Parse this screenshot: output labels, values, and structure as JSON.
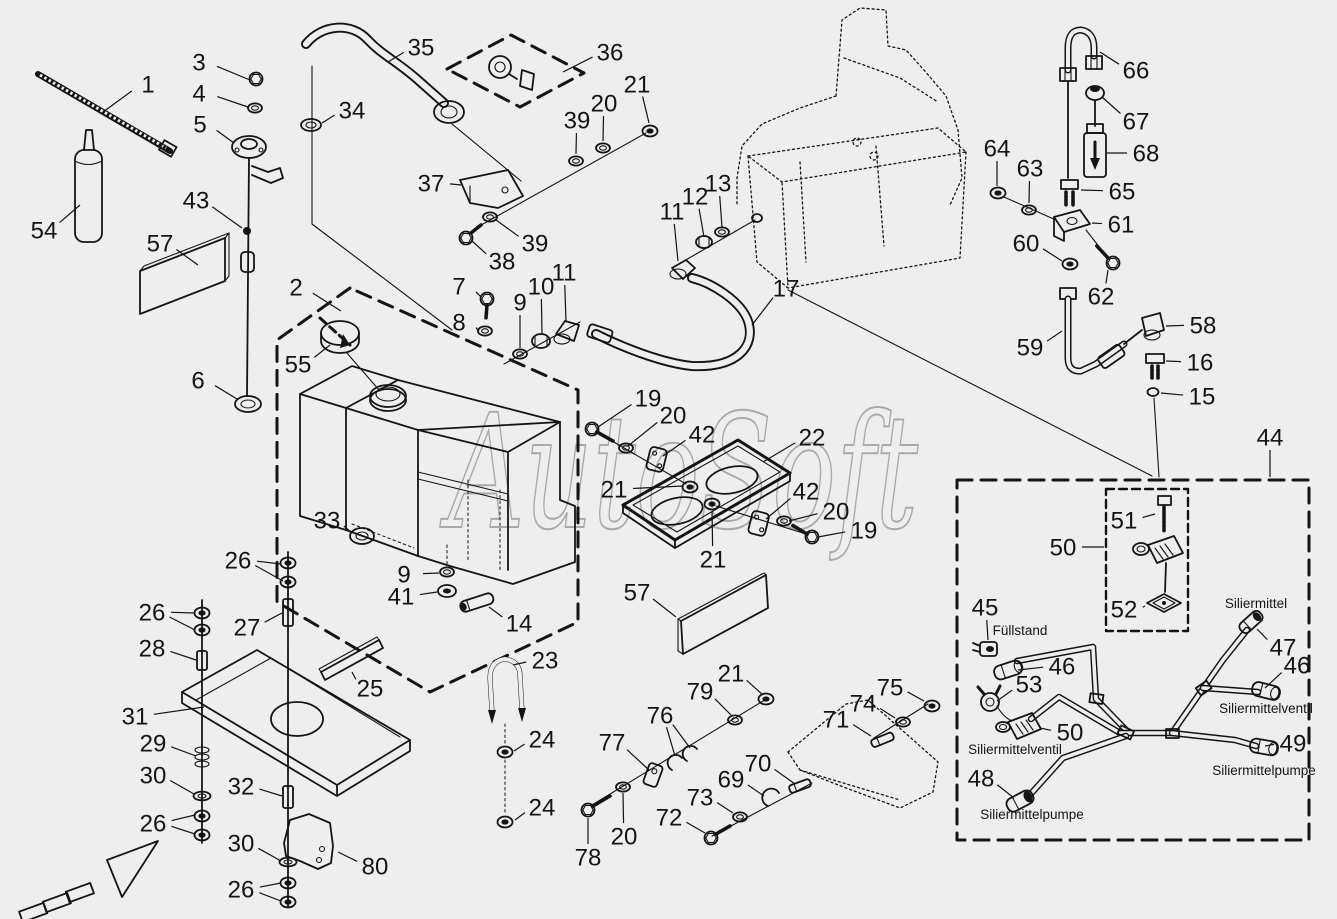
{
  "watermark": "AutoSoft",
  "colors": {
    "background": "#eeeeee",
    "line": "#141414",
    "watermark": "#a9a9a9"
  },
  "annotations": [
    {
      "text": "Füllstand",
      "x": 1020,
      "y": 631
    },
    {
      "text": "Siliermittel",
      "x": 1256,
      "y": 604
    },
    {
      "text": "Siliermittelventil",
      "x": 1015,
      "y": 750
    },
    {
      "text": "Siliermittelventil",
      "x": 1266,
      "y": 709
    },
    {
      "text": "Siliermittelpumpe",
      "x": 1032,
      "y": 815
    },
    {
      "text": "Siliermittelpumpe",
      "x": 1264,
      "y": 771
    }
  ],
  "callouts": [
    {
      "n": "1",
      "x": 148,
      "y": 84,
      "tx": 103,
      "ty": 112
    },
    {
      "n": "3",
      "x": 199,
      "y": 62,
      "tx": 250,
      "ty": 80
    },
    {
      "n": "4",
      "x": 199,
      "y": 93,
      "tx": 248,
      "ty": 107
    },
    {
      "n": "5",
      "x": 200,
      "y": 124,
      "tx": 234,
      "ty": 143
    },
    {
      "n": "54",
      "x": 44,
      "y": 230,
      "tx": 80,
      "ty": 205
    },
    {
      "n": "57",
      "x": 160,
      "y": 243,
      "tx": 198,
      "ty": 265
    },
    {
      "n": "43",
      "x": 196,
      "y": 200,
      "tx": 242,
      "ty": 228
    },
    {
      "n": "6",
      "x": 198,
      "y": 380,
      "tx": 237,
      "ty": 399
    },
    {
      "n": "2",
      "x": 296,
      "y": 287,
      "tx": 341,
      "ty": 311
    },
    {
      "n": "55",
      "x": 298,
      "y": 364,
      "tx": 330,
      "ty": 345
    },
    {
      "n": "35",
      "x": 421,
      "y": 47,
      "tx": 388,
      "ty": 62
    },
    {
      "n": "34",
      "x": 352,
      "y": 110,
      "tx": 322,
      "ty": 123
    },
    {
      "n": "36",
      "x": 610,
      "y": 52,
      "tx": 563,
      "ty": 72
    },
    {
      "n": "39",
      "x": 577,
      "y": 120,
      "tx": 576,
      "ty": 154
    },
    {
      "n": "20",
      "x": 604,
      "y": 103,
      "tx": 603,
      "ty": 141
    },
    {
      "n": "21",
      "x": 637,
      "y": 84,
      "tx": 649,
      "ty": 123
    },
    {
      "n": "37",
      "x": 431,
      "y": 183,
      "tx": 461,
      "ty": 185
    },
    {
      "n": "39",
      "x": 535,
      "y": 243,
      "tx": 496,
      "ty": 220
    },
    {
      "n": "38",
      "x": 502,
      "y": 261,
      "tx": 472,
      "ty": 241
    },
    {
      "n": "7",
      "x": 459,
      "y": 286,
      "tx": 481,
      "ty": 297
    },
    {
      "n": "8",
      "x": 459,
      "y": 322,
      "tx": 478,
      "ty": 331
    },
    {
      "n": "9",
      "x": 520,
      "y": 302,
      "tx": 520,
      "ty": 348
    },
    {
      "n": "10",
      "x": 541,
      "y": 286,
      "tx": 542,
      "ty": 334
    },
    {
      "n": "11",
      "x": 564,
      "y": 272,
      "tx": 566,
      "ty": 321
    },
    {
      "n": "11",
      "x": 672,
      "y": 211,
      "tx": 678,
      "ty": 261
    },
    {
      "n": "12",
      "x": 695,
      "y": 196,
      "tx": 704,
      "ty": 237
    },
    {
      "n": "13",
      "x": 718,
      "y": 183,
      "tx": 722,
      "ty": 227
    },
    {
      "n": "17",
      "x": 786,
      "y": 288,
      "tx": 752,
      "ty": 325
    },
    {
      "n": "19",
      "x": 648,
      "y": 398,
      "tx": 598,
      "ty": 427
    },
    {
      "n": "20",
      "x": 673,
      "y": 415,
      "tx": 628,
      "ty": 446
    },
    {
      "n": "42",
      "x": 702,
      "y": 434,
      "tx": 663,
      "ty": 456
    },
    {
      "n": "22",
      "x": 812,
      "y": 437,
      "tx": 763,
      "ty": 462
    },
    {
      "n": "21",
      "x": 614,
      "y": 489,
      "tx": 683,
      "ty": 486
    },
    {
      "n": "42",
      "x": 806,
      "y": 491,
      "tx": 766,
      "ty": 519
    },
    {
      "n": "20",
      "x": 836,
      "y": 511,
      "tx": 789,
      "ty": 521
    },
    {
      "n": "19",
      "x": 864,
      "y": 530,
      "tx": 818,
      "ty": 537
    },
    {
      "n": "21",
      "x": 713,
      "y": 559,
      "tx": 712,
      "ty": 511
    },
    {
      "n": "33",
      "x": 327,
      "y": 520,
      "tx": 352,
      "ty": 533
    },
    {
      "n": "9",
      "x": 404,
      "y": 574,
      "tx": 439,
      "ty": 573
    },
    {
      "n": "41",
      "x": 401,
      "y": 596,
      "tx": 437,
      "ty": 592
    },
    {
      "n": "14",
      "x": 519,
      "y": 623,
      "tx": 489,
      "ty": 607
    },
    {
      "n": "57",
      "x": 637,
      "y": 592,
      "tx": 676,
      "ty": 617
    },
    {
      "n": "26",
      "x": 238,
      "y": 560,
      "tx": 281,
      "ty": 564,
      "tx2": 283,
      "ty2": 581
    },
    {
      "n": "27",
      "x": 247,
      "y": 627,
      "tx": 282,
      "ty": 613
    },
    {
      "n": "26",
      "x": 152,
      "y": 612,
      "tx": 195,
      "ty": 613,
      "tx2": 195,
      "ty2": 630
    },
    {
      "n": "28",
      "x": 152,
      "y": 648,
      "tx": 196,
      "ty": 660
    },
    {
      "n": "31",
      "x": 135,
      "y": 716,
      "tx": 204,
      "ty": 707
    },
    {
      "n": "29",
      "x": 153,
      "y": 743,
      "tx": 196,
      "ty": 756
    },
    {
      "n": "30",
      "x": 153,
      "y": 775,
      "tx": 194,
      "ty": 794
    },
    {
      "n": "26",
      "x": 153,
      "y": 823,
      "tx": 195,
      "ty": 815,
      "tx2": 195,
      "ty2": 834
    },
    {
      "n": "25",
      "x": 370,
      "y": 688,
      "tx": 352,
      "ty": 672
    },
    {
      "n": "23",
      "x": 545,
      "y": 660,
      "tx": 513,
      "ty": 665
    },
    {
      "n": "24",
      "x": 542,
      "y": 739,
      "tx": 514,
      "ty": 751
    },
    {
      "n": "24",
      "x": 542,
      "y": 807,
      "tx": 515,
      "ty": 820
    },
    {
      "n": "32",
      "x": 241,
      "y": 786,
      "tx": 282,
      "ty": 796
    },
    {
      "n": "30",
      "x": 241,
      "y": 843,
      "tx": 281,
      "ty": 861
    },
    {
      "n": "26",
      "x": 241,
      "y": 889,
      "tx": 281,
      "ty": 883,
      "tx2": 281,
      "ty2": 901
    },
    {
      "n": "80",
      "x": 375,
      "y": 866,
      "tx": 338,
      "ty": 852
    },
    {
      "n": "78",
      "x": 588,
      "y": 857,
      "tx": 588,
      "ty": 818
    },
    {
      "n": "20",
      "x": 624,
      "y": 836,
      "tx": 623,
      "ty": 793
    },
    {
      "n": "77",
      "x": 612,
      "y": 742,
      "tx": 649,
      "ty": 770
    },
    {
      "n": "76",
      "x": 660,
      "y": 715,
      "tx": 675,
      "ty": 756,
      "tx2": 690,
      "ty2": 748
    },
    {
      "n": "79",
      "x": 700,
      "y": 691,
      "tx": 731,
      "ty": 715
    },
    {
      "n": "21",
      "x": 731,
      "y": 673,
      "tx": 763,
      "ty": 695
    },
    {
      "n": "72",
      "x": 669,
      "y": 817,
      "tx": 705,
      "ty": 833
    },
    {
      "n": "73",
      "x": 700,
      "y": 797,
      "tx": 733,
      "ty": 813
    },
    {
      "n": "69",
      "x": 731,
      "y": 779,
      "tx": 764,
      "ty": 796
    },
    {
      "n": "70",
      "x": 758,
      "y": 763,
      "tx": 795,
      "ty": 784
    },
    {
      "n": "71",
      "x": 836,
      "y": 719,
      "tx": 871,
      "ty": 736
    },
    {
      "n": "74",
      "x": 863,
      "y": 703,
      "tx": 895,
      "ty": 718
    },
    {
      "n": "75",
      "x": 890,
      "y": 687,
      "tx": 924,
      "ty": 701
    },
    {
      "n": "64",
      "x": 997,
      "y": 148,
      "tx": 997,
      "ty": 186
    },
    {
      "n": "63",
      "x": 1030,
      "y": 168,
      "tx": 1029,
      "ty": 203
    },
    {
      "n": "66",
      "x": 1136,
      "y": 70,
      "tx": 1100,
      "ty": 52
    },
    {
      "n": "67",
      "x": 1136,
      "y": 121,
      "tx": 1102,
      "ty": 97
    },
    {
      "n": "68",
      "x": 1146,
      "y": 153,
      "tx": 1107,
      "ty": 153
    },
    {
      "n": "65",
      "x": 1122,
      "y": 191,
      "tx": 1081,
      "ty": 190
    },
    {
      "n": "61",
      "x": 1121,
      "y": 224,
      "tx": 1092,
      "ty": 223
    },
    {
      "n": "60",
      "x": 1026,
      "y": 243,
      "tx": 1062,
      "ty": 261
    },
    {
      "n": "62",
      "x": 1101,
      "y": 296,
      "tx": 1108,
      "ty": 270
    },
    {
      "n": "59",
      "x": 1030,
      "y": 347,
      "tx": 1062,
      "ty": 331
    },
    {
      "n": "58",
      "x": 1203,
      "y": 325,
      "tx": 1166,
      "ty": 326
    },
    {
      "n": "16",
      "x": 1200,
      "y": 362,
      "tx": 1166,
      "ty": 361
    },
    {
      "n": "15",
      "x": 1202,
      "y": 396,
      "tx": 1161,
      "ty": 393
    },
    {
      "n": "44",
      "x": 1270,
      "y": 437,
      "tx": 1270,
      "ty": 477
    },
    {
      "n": "51",
      "x": 1124,
      "y": 520,
      "tx": 1155,
      "ty": 514
    },
    {
      "n": "50",
      "x": 1063,
      "y": 547,
      "tx": 1104,
      "ty": 547
    },
    {
      "n": "52",
      "x": 1124,
      "y": 609,
      "tx": 1145,
      "ty": 606
    },
    {
      "n": "45",
      "x": 985,
      "y": 607,
      "tx": 988,
      "ty": 640
    },
    {
      "n": "46",
      "x": 1062,
      "y": 666,
      "tx": 1018,
      "ty": 670
    },
    {
      "n": "53",
      "x": 1029,
      "y": 684,
      "tx": 997,
      "ty": 701
    },
    {
      "n": "50",
      "x": 1070,
      "y": 732,
      "tx": 1040,
      "ty": 728
    },
    {
      "n": "48",
      "x": 981,
      "y": 778,
      "tx": 1014,
      "ty": 798
    },
    {
      "n": "47",
      "x": 1283,
      "y": 647,
      "tx": 1257,
      "ty": 629
    },
    {
      "n": "46",
      "x": 1297,
      "y": 665,
      "tx": 1265,
      "ty": 688
    },
    {
      "n": "49",
      "x": 1293,
      "y": 743,
      "tx": 1265,
      "ty": 746
    }
  ]
}
